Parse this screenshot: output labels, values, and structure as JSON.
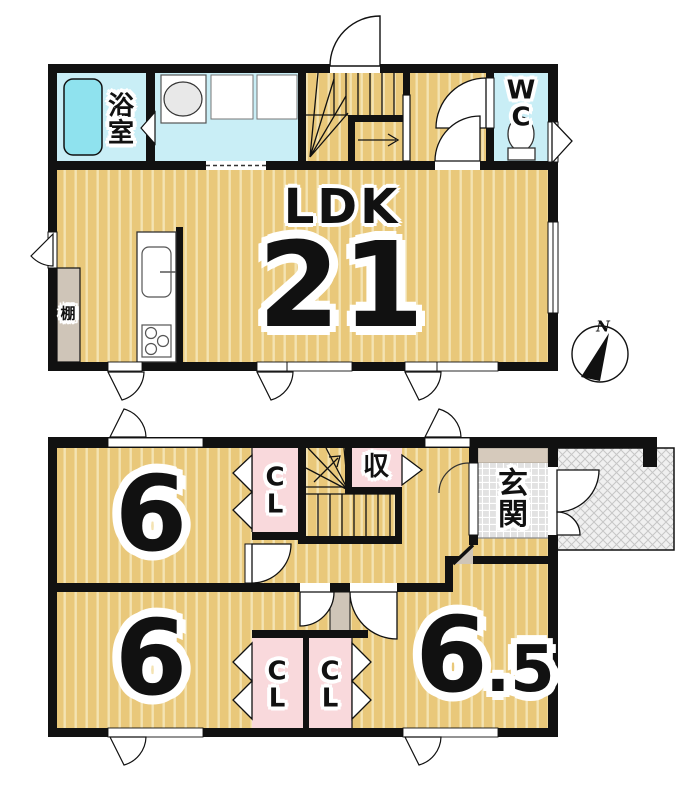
{
  "floor2": {
    "ldk_label": "LDK",
    "ldk_size": "21",
    "bath_label": "浴室",
    "wc_label": "WC",
    "shelf_label": "棚"
  },
  "floor1": {
    "bedroom_top": "6",
    "bedroom_bottom": "6",
    "bedroom_right_main": "6",
    "bedroom_right_suffix": ".5",
    "closet_top": "CL",
    "closet_bottom_left": "CL",
    "closet_bottom_right": "CL",
    "storage_label": "収",
    "entrance_label": "玄関"
  },
  "compass": {
    "north": "N"
  },
  "colors": {
    "wood_floor": "#e9c87a",
    "wood_stripe": "#f4e3b2",
    "water_floor": "#c9eef6",
    "bathtub": "#8fe2ee",
    "closet_pink": "#f9d9dc",
    "shelf_beige": "#cfc5b8",
    "entrance_step": "#d6cabc",
    "wall": "#111111"
  }
}
